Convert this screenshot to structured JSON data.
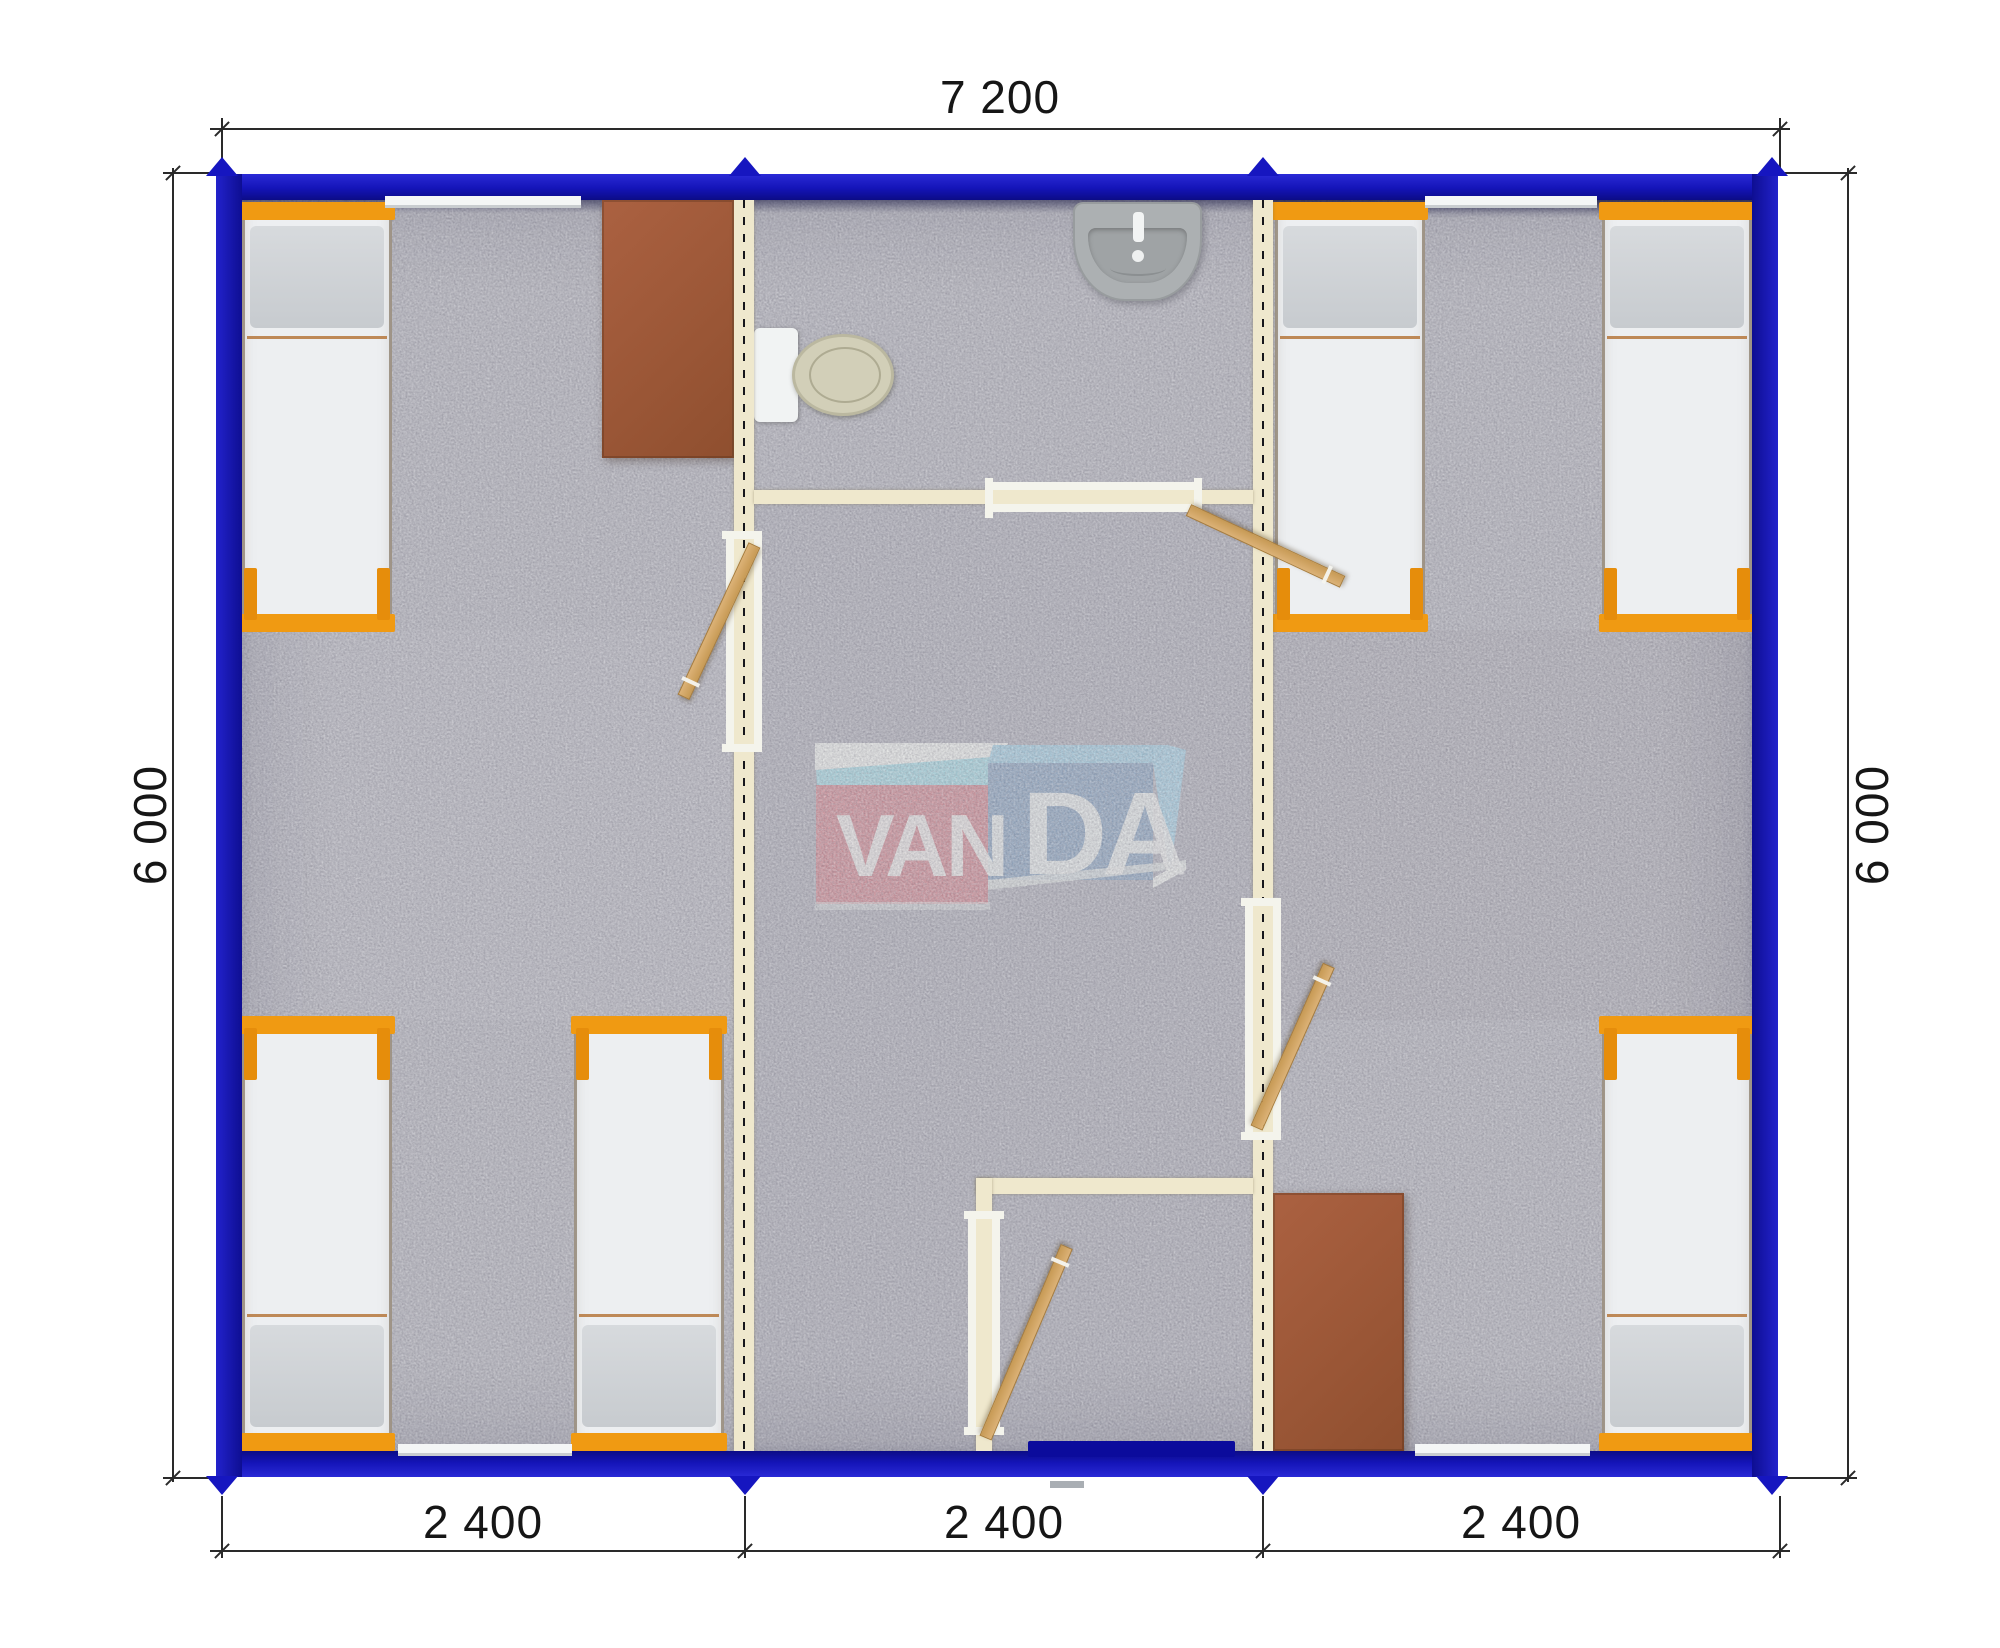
{
  "title": "VANDA modular building floor plan",
  "dimensions": {
    "top": {
      "label": "7 200"
    },
    "left": {
      "label": "6 000"
    },
    "right": {
      "label": "6 000"
    },
    "bottom": [
      {
        "label": "2 400"
      },
      {
        "label": "2 400"
      },
      {
        "label": "2 400"
      }
    ]
  },
  "watermark": {
    "brand": "VANDA",
    "left_letters": "VAN",
    "right_letters": "DA"
  },
  "colors": {
    "wall-blue": "#1616c0",
    "entry-blue": "#0b0b9c",
    "partition-cream": "#efe8cd",
    "jamb-white": "#f4f4ec",
    "floor-grey": "#b2b2ba",
    "bed-orange": "#f09a12",
    "mattress-white": "#edeff1",
    "blanket-tan": "#b5773c",
    "desk-brown": "#a05a3a",
    "door-wood": "#d4ab69",
    "toilet-bowl": "#d2cfb8",
    "sink-grey": "#acb0b2",
    "dim-line": "#2a2a2a",
    "logo-red": "#cf8b93",
    "logo-cyan": "#a5d5de",
    "logo-blue-front": "#8da5be",
    "logo-blue-top": "#a2cbdd",
    "logo-white": "#e9ebe8"
  }
}
